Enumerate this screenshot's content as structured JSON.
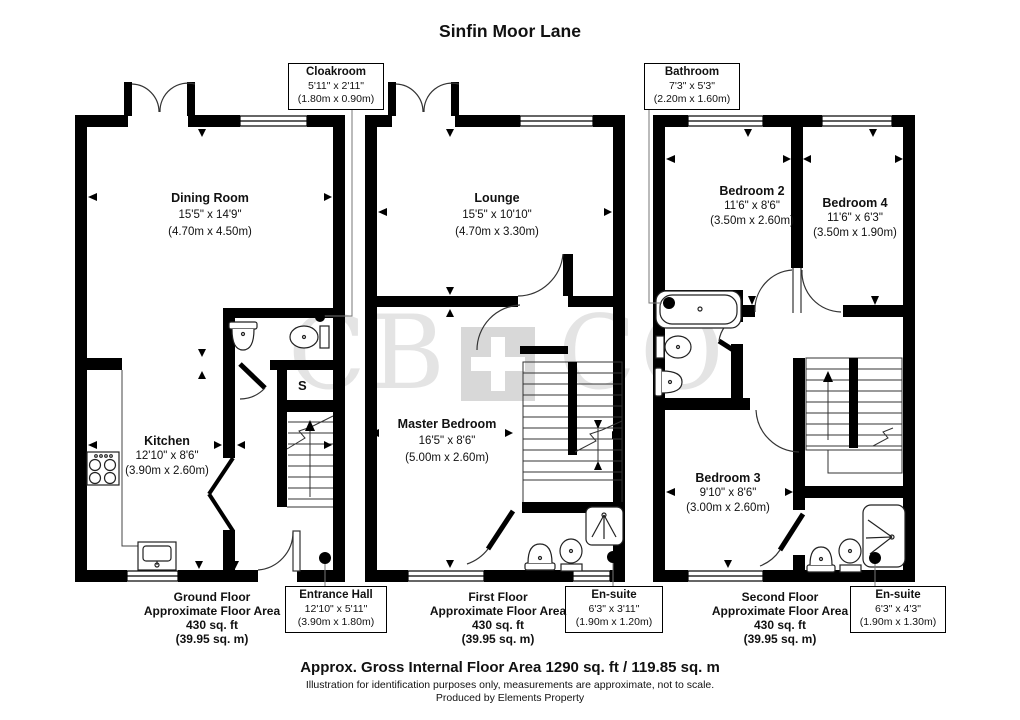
{
  "title": "Sinfin Moor Lane",
  "watermark": {
    "left": "CB",
    "right": "CO"
  },
  "ground": {
    "rooms": {
      "dining": {
        "name": "Dining Room",
        "imperial": "15'5\" x 14'9\"",
        "metric": "(4.70m x 4.50m)"
      },
      "kitchen": {
        "name": "Kitchen",
        "imperial": "12'10\" x 8'6\"",
        "metric": "(3.90m x 2.60m)"
      },
      "storage": {
        "label": "S"
      }
    },
    "callouts": {
      "cloakroom": {
        "name": "Cloakroom",
        "imperial": "5'11\" x 2'11\"",
        "metric": "(1.80m x 0.90m)"
      },
      "entrance_hall": {
        "name": "Entrance Hall",
        "imperial": "12'10\" x 5'11\"",
        "metric": "(3.90m x 1.80m)"
      }
    },
    "floor_label": {
      "name": "Ground Floor",
      "line2": "Approximate Floor Area",
      "area_ft": "430 sq. ft",
      "area_m": "(39.95 sq. m)"
    }
  },
  "first": {
    "rooms": {
      "lounge": {
        "name": "Lounge",
        "imperial": "15'5\" x 10'10\"",
        "metric": "(4.70m x 3.30m)"
      },
      "master": {
        "name": "Master Bedroom",
        "imperial": "16'5\" x 8'6\"",
        "metric": "(5.00m x 2.60m)"
      }
    },
    "callouts": {
      "ensuite": {
        "name": "En-suite",
        "imperial": "6'3\" x 3'11\"",
        "metric": "(1.90m x 1.20m)"
      }
    },
    "floor_label": {
      "name": "First Floor",
      "line2": "Approximate Floor Area",
      "area_ft": "430 sq. ft",
      "area_m": "(39.95 sq. m)"
    }
  },
  "second": {
    "rooms": {
      "bedroom2": {
        "name": "Bedroom 2",
        "imperial": "11'6\" x 8'6\"",
        "metric": "(3.50m x 2.60m)"
      },
      "bedroom4": {
        "name": "Bedroom 4",
        "imperial": "11'6\" x 6'3\"",
        "metric": "(3.50m x 1.90m)"
      },
      "bedroom3": {
        "name": "Bedroom 3",
        "imperial": "9'10\" x 8'6\"",
        "metric": "(3.00m x 2.60m)"
      }
    },
    "callouts": {
      "bathroom": {
        "name": "Bathroom",
        "imperial": "7'3\" x 5'3\"",
        "metric": "(2.20m x 1.60m)"
      },
      "ensuite": {
        "name": "En-suite",
        "imperial": "6'3\" x 4'3\"",
        "metric": "(1.90m x 1.30m)"
      }
    },
    "floor_label": {
      "name": "Second Floor",
      "line2": "Approximate Floor Area",
      "area_ft": "430 sq. ft",
      "area_m": "(39.95 sq. m)"
    }
  },
  "footer": {
    "gross": "Approx. Gross Internal Floor Area 1290 sq. ft / 119.85 sq. m",
    "disclaimer": "Illustration for identification purposes only, measurements are approximate, not to scale.",
    "credit": "Produced by Elements Property"
  }
}
